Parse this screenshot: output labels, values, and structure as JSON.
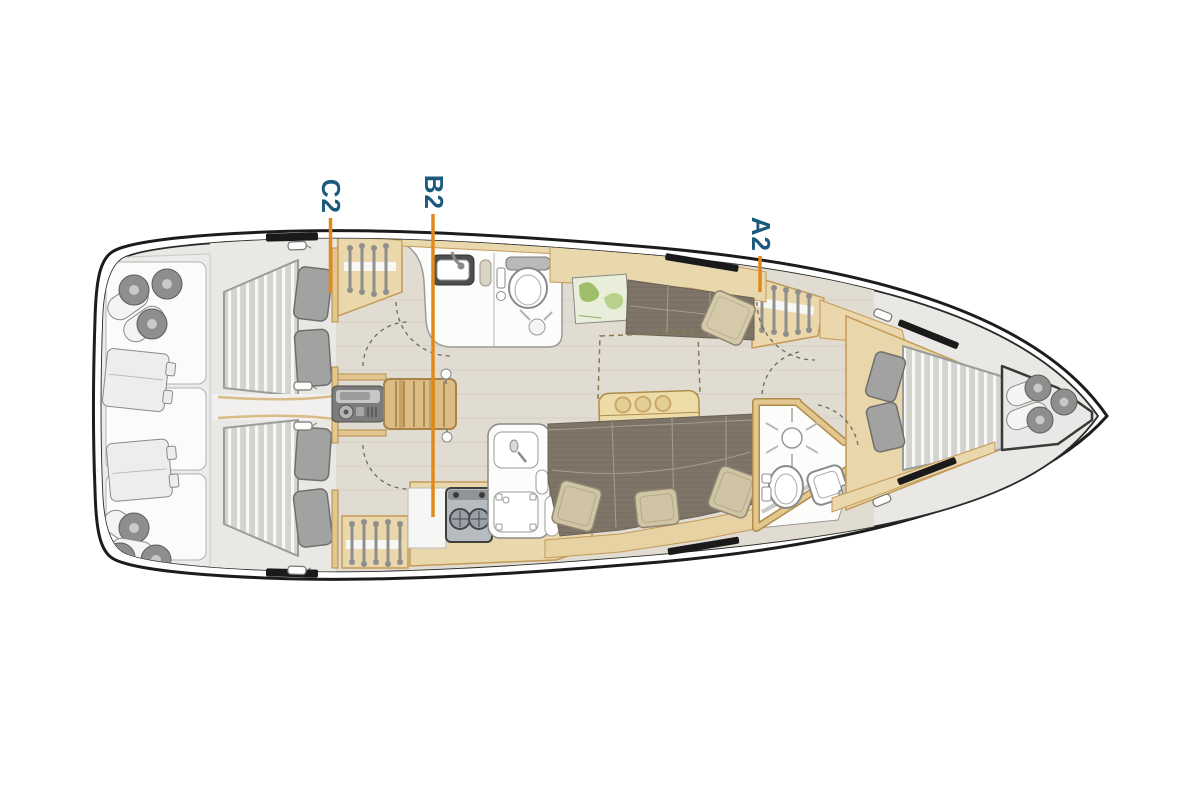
{
  "diagram": {
    "type": "yacht-interior-floor-plan",
    "view": "top-down, bow pointing right",
    "markers": {
      "a2": {
        "label": "A2"
      },
      "b2": {
        "label": "B2"
      },
      "c2": {
        "label": "C2"
      }
    },
    "colors": {
      "marker_text": "#1b5a7c",
      "marker_line": "#e2891b",
      "hull_outline": "#1c1c1c",
      "deck_rim": "#ffffff",
      "floor": "#e1dcd1",
      "wood": "#ead8ad",
      "wood_trim": "#c49a58",
      "upholstery": "#7e7568",
      "mattress": "#d3d3d0",
      "pillow_gray": "#a2a2a0",
      "pillow_beige": "#cfc4a3",
      "fixture_white": "#fcfcfb",
      "hatch_black": "#1a1a1a"
    },
    "features": [
      "stern-lockers-with-fenders",
      "aft-cabin-port-double-berth",
      "aft-cabin-starboard-double-berth",
      "hanging-lockers-with-hangers",
      "aft-head-with-sink-and-toilet",
      "companionway-steps-with-engine-box",
      "galley-with-stove-and-sink",
      "chart-table-with-map",
      "saloon-table-with-cupholders",
      "port-settee-with-pillow",
      "starboard-sofa-with-pillows",
      "forward-head-with-shower-toilet-sink",
      "forward-cabin-v-berth",
      "bow-locker-with-fenders",
      "deck-hatches",
      "door-swing-arcs"
    ]
  }
}
